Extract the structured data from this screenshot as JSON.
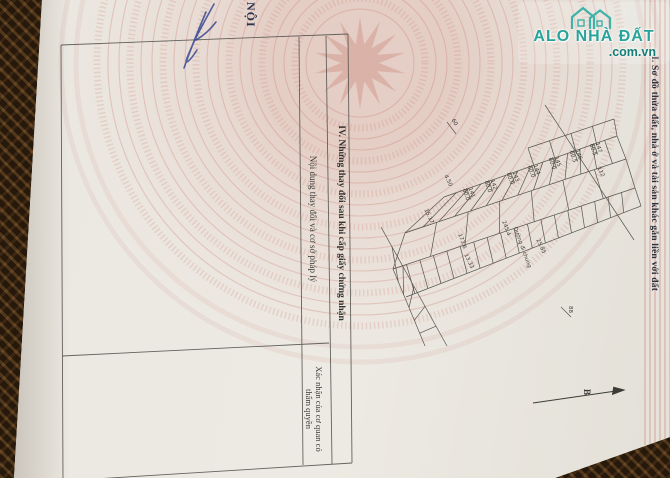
{
  "watermark": {
    "brand": "ALO NHÀ ĐẤT",
    "domain": ".com.vn"
  },
  "page": {
    "section_heading": "I. Sơ đồ thửa đất, nhà ở và tài sản khác gắn liền với đất",
    "handwriting": "NỘI",
    "north_label": "B"
  },
  "table": {
    "title": "IV. Những thay đổi sau khi cấp giấy chứng nhận",
    "col1_header": "Nội dung thay đổi và cơ sở pháp lý",
    "col2_header": "Xác nhận của cơ quan có thẩm quyền"
  },
  "sketch": {
    "road_label": "Đường đi chung",
    "labels": [
      {
        "x": 472,
        "y": 186,
        "rot": 70,
        "top": "141",
        "bottom": "60.0"
      },
      {
        "x": 494,
        "y": 178,
        "rot": 70,
        "top": "142",
        "bottom": "60.0"
      },
      {
        "x": 516,
        "y": 170,
        "rot": 70,
        "top": "143",
        "bottom": "60.0"
      },
      {
        "x": 537,
        "y": 163,
        "rot": 70,
        "top": "144",
        "bottom": "60.0"
      },
      {
        "x": 558,
        "y": 155,
        "rot": 70,
        "top": "145",
        "bottom": "60.0"
      },
      {
        "x": 579,
        "y": 148,
        "rot": 70,
        "top": "146",
        "bottom": "60.5"
      },
      {
        "x": 599,
        "y": 141,
        "rot": 70,
        "top": "147",
        "bottom": "60.5"
      },
      {
        "x": 462,
        "y": 233,
        "rot": 70,
        "top": "173.6"
      },
      {
        "x": 506,
        "y": 220,
        "rot": 70,
        "top": "245.4"
      },
      {
        "x": 601,
        "y": 166,
        "rot": 65,
        "top": "112"
      },
      {
        "x": 448,
        "y": 174,
        "rot": 65,
        "top": "4.50"
      },
      {
        "x": 428,
        "y": 208,
        "rot": 65,
        "top": "15.17"
      },
      {
        "x": 468,
        "y": 253,
        "rot": 65,
        "top": "13.33"
      },
      {
        "x": 540,
        "y": 238,
        "rot": 65,
        "top": "25.85"
      },
      {
        "x": 455,
        "y": 118,
        "rot": 60,
        "top": "60"
      },
      {
        "x": 573,
        "y": 306,
        "rot": 90,
        "top": "88"
      }
    ]
  },
  "colors": {
    "accent_teal": "#27a49a",
    "domain_teal": "#157d77",
    "paper": "#e9e6df",
    "mat_brown": "#241709",
    "emblem_pink": "#c8766a",
    "ink_blue": "#2c3e8f",
    "line_gray": "#55544e"
  }
}
